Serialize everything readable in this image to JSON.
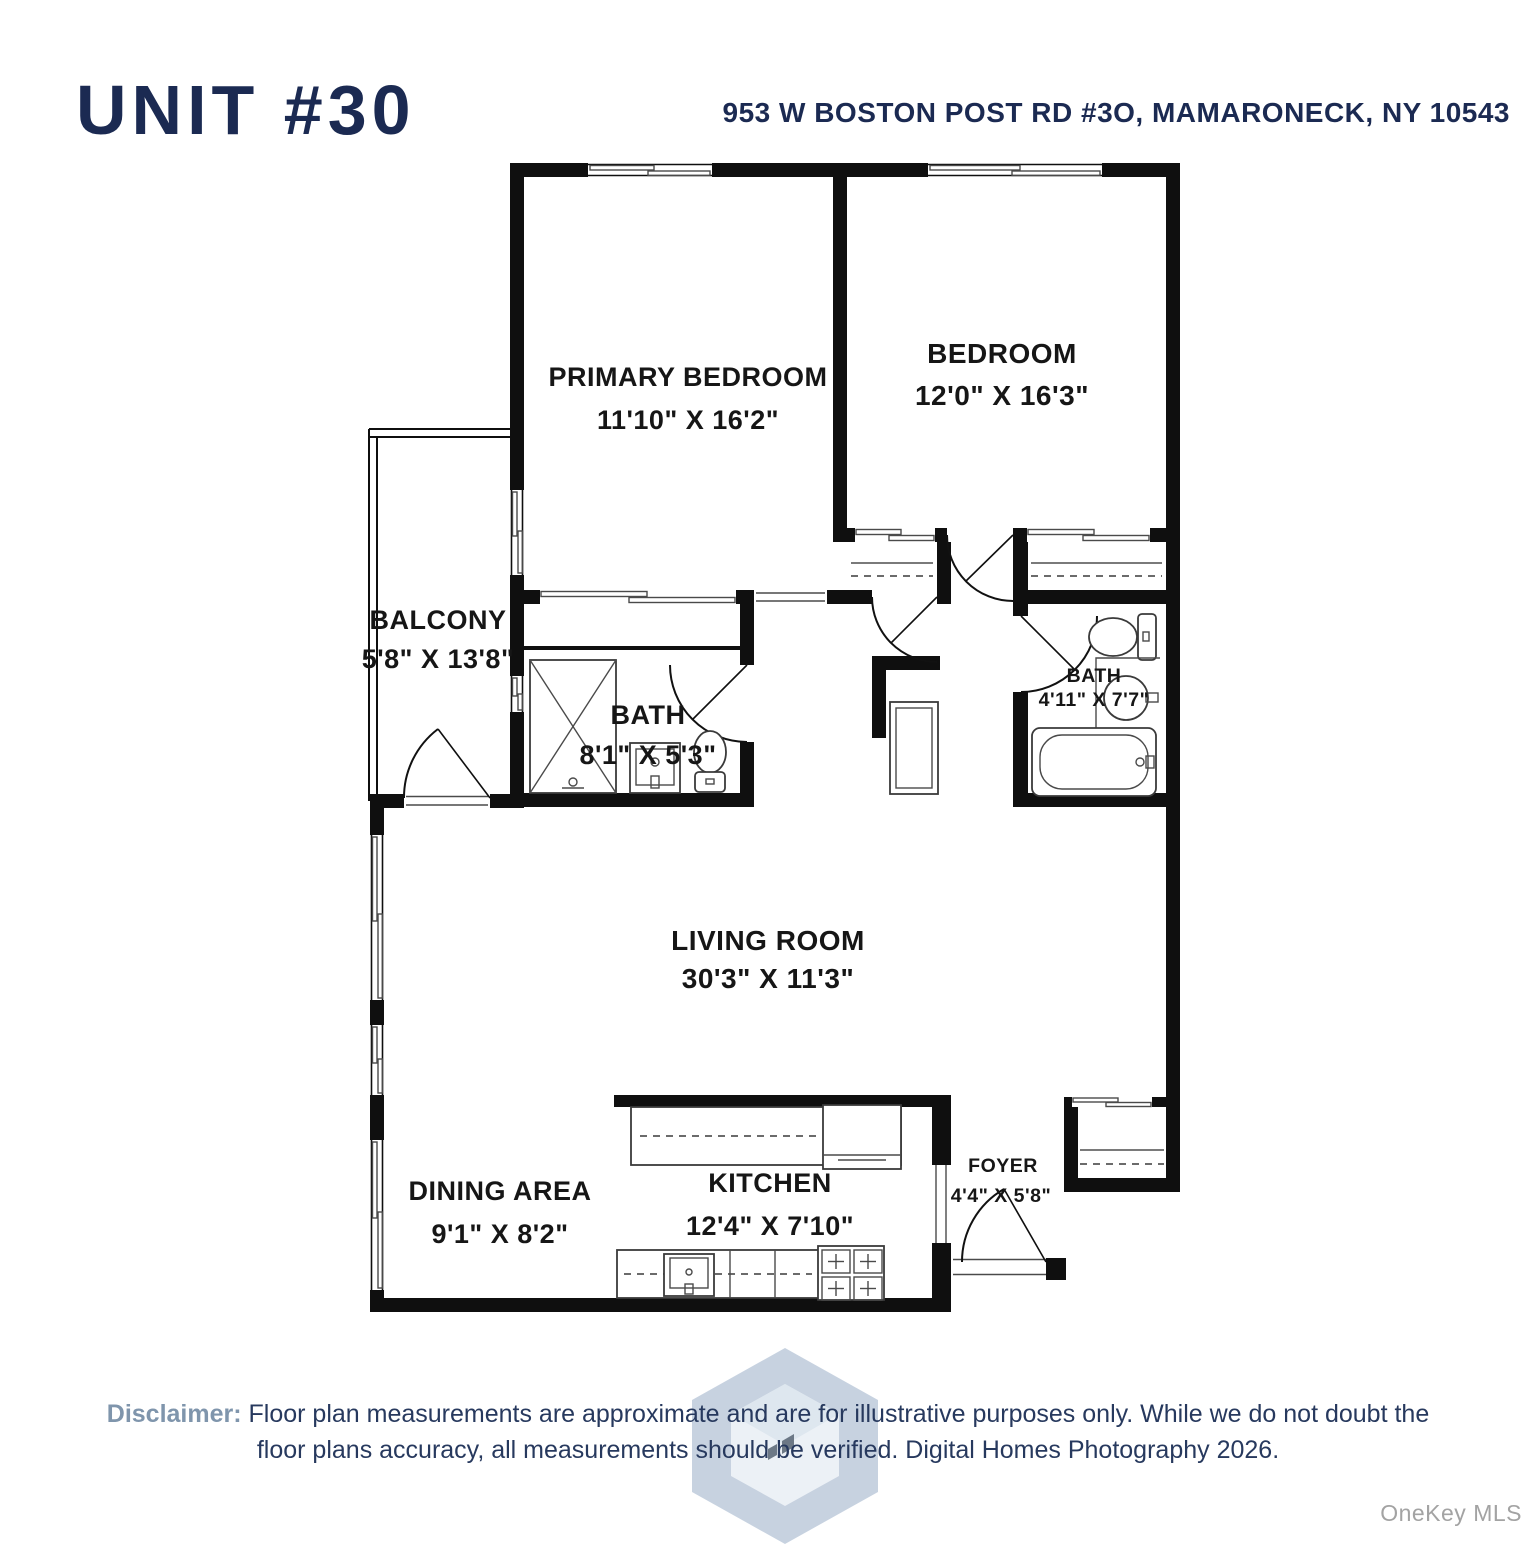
{
  "page": {
    "title": "UNIT #30",
    "address": "953 W BOSTON POST RD #3O, MAMARONECK, NY 10543"
  },
  "rooms": {
    "primary_bedroom": {
      "name": "PRIMARY BEDROOM",
      "dims": "11'10\" X 16'2\""
    },
    "bedroom": {
      "name": "BEDROOM",
      "dims": "12'0\" X 16'3\""
    },
    "balcony": {
      "name": "BALCONY",
      "dims": "5'8\" X 13'8\""
    },
    "bath_primary": {
      "name": "BATH",
      "dims": "8'1\" X 5'3\""
    },
    "bath_hall": {
      "name": "BATH",
      "dims": "4'11\" X 7'7\""
    },
    "living_room": {
      "name": "LIVING ROOM",
      "dims": "30'3\" X 11'3\""
    },
    "dining_area": {
      "name": "DINING AREA",
      "dims": "9'1\" X 8'2\""
    },
    "kitchen": {
      "name": "KITCHEN",
      "dims": "12'4\" X 7'10\""
    },
    "foyer": {
      "name": "FOYER",
      "dims": "4'4\" X 5'8\""
    }
  },
  "footer": {
    "disclaimer_label": "Disclaimer:",
    "disclaimer_line1": "Floor plan measurements are approximate and are for illustrative purposes only. While we do not doubt the",
    "disclaimer_line2": "floor plans accuracy, all measurements should be verified. Digital Homes Photography 2026.",
    "watermark": "OneKey MLS"
  },
  "colors": {
    "navy": "#1b2a52",
    "disclaimer_label": "#7f95ac",
    "plan_ink": "#0f0f0f",
    "watermark_gray": "#a3a3a3",
    "logo_blue": "#b7c5d7"
  }
}
